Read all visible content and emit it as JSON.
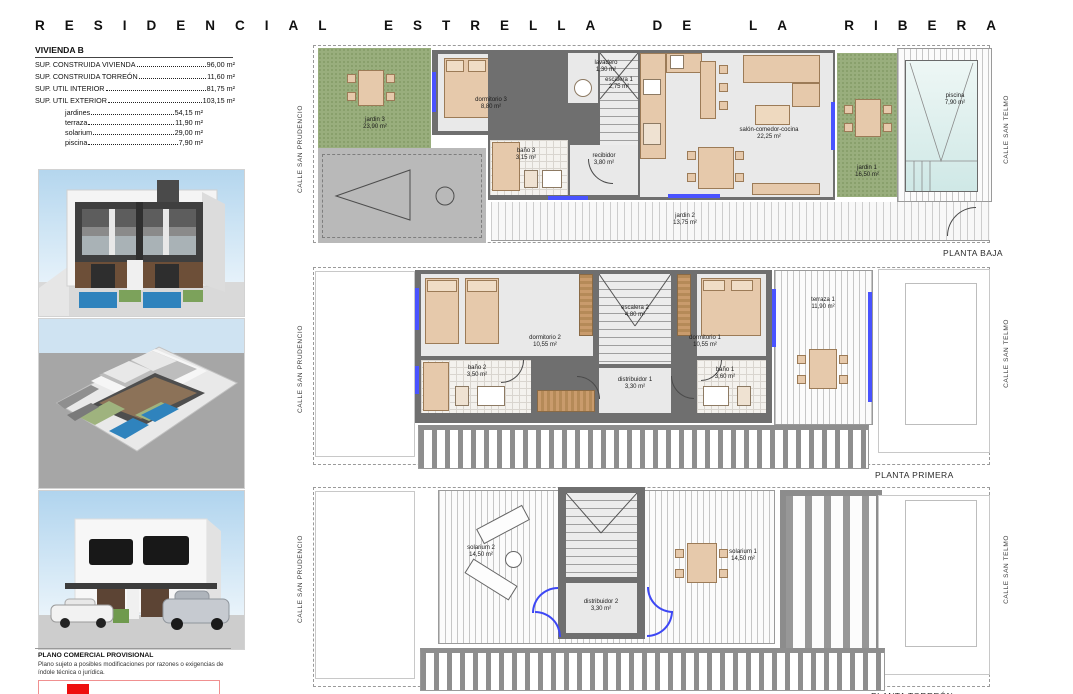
{
  "header": {
    "title": "RESIDENCIAL ESTRELLA DE LA RIBERA"
  },
  "unit": {
    "heading": "VIVIENDA B",
    "surfaces": [
      {
        "label": "SUP. CONSTRUIDA VIVIENDA",
        "value": "96,00 m²"
      },
      {
        "label": "SUP. CONSTRUIDA TORREÓN",
        "value": "11,60 m²"
      },
      {
        "label": "SUP. UTIL INTERIOR",
        "value": "81,75 m²"
      },
      {
        "label": "SUP. UTIL EXTERIOR",
        "value": "103,15 m²"
      },
      {
        "label": "jardines",
        "value": "54,15 m²"
      },
      {
        "label": "terraza",
        "value": "11,90 m²"
      },
      {
        "label": "solarium",
        "value": "29,00 m²"
      },
      {
        "label": "piscina",
        "value": "7,90 m²"
      }
    ]
  },
  "streets": {
    "left": "CALLE SAN PRUDENCIO",
    "right": "CALLE SAN TELMO"
  },
  "plans": {
    "baja": {
      "label": "PLANTA BAJA",
      "rooms": {
        "jardin3": {
          "name": "jardin 3",
          "area": "23,90 m²"
        },
        "dormitorio3": {
          "name": "dormitorio 3",
          "area": "8,80 m²"
        },
        "lavadero": {
          "name": "lavadero",
          "area": "1,30 m²"
        },
        "escalera1": {
          "name": "escalera 1",
          "area": "2,75 m²"
        },
        "bano3": {
          "name": "baño 3",
          "area": "3,15 m²"
        },
        "recibidor": {
          "name": "recibidor",
          "area": "3,80 m²"
        },
        "salon": {
          "name": "salón-comedor-cocina",
          "area": "22,25 m²"
        },
        "jardin1": {
          "name": "jardin 1",
          "area": "16,50 m²"
        },
        "piscina": {
          "name": "piscina",
          "area": "7,90 m²"
        },
        "jardin2": {
          "name": "jardin 2",
          "area": "13,75 m²"
        }
      }
    },
    "primera": {
      "label": "PLANTA PRIMERA",
      "rooms": {
        "dormitorio2": {
          "name": "dormitorio 2",
          "area": "10,55 m²"
        },
        "escalera2": {
          "name": "escalera 2",
          "area": "4,80 m²"
        },
        "dormitorio1": {
          "name": "dormitorio 1",
          "area": "10,55 m²"
        },
        "bano2": {
          "name": "baño 2",
          "area": "3,50 m²"
        },
        "distribuidor1": {
          "name": "distribuidor 1",
          "area": "3,30 m²"
        },
        "bano1": {
          "name": "baño 1",
          "area": "3,60 m²"
        },
        "terraza1": {
          "name": "terraza 1",
          "area": "11,90 m²"
        }
      }
    },
    "torreon": {
      "label": "PLANTA TORREÓN",
      "rooms": {
        "solarium2": {
          "name": "solarium 2",
          "area": "14,50 m²"
        },
        "distribuidor2": {
          "name": "distribuidor 2",
          "area": "3,30 m²"
        },
        "solarium1": {
          "name": "solarium 1",
          "area": "14,50 m²"
        }
      }
    }
  },
  "disclaimer": {
    "title": "PLANO COMERCIAL PROVISIONAL",
    "body": "Plano sujeto a posibles modificaciones por razones o exigencias de índole técnica o jurídica."
  },
  "colors": {
    "wall": "#6f6f6f",
    "floor": "#e9e9e9",
    "garden": "#99ae7d",
    "pool": "#d6ebe9",
    "window_marker": "#4953ff",
    "furniture": "#e6c9ab",
    "legend_red": "#ee0e0e"
  }
}
